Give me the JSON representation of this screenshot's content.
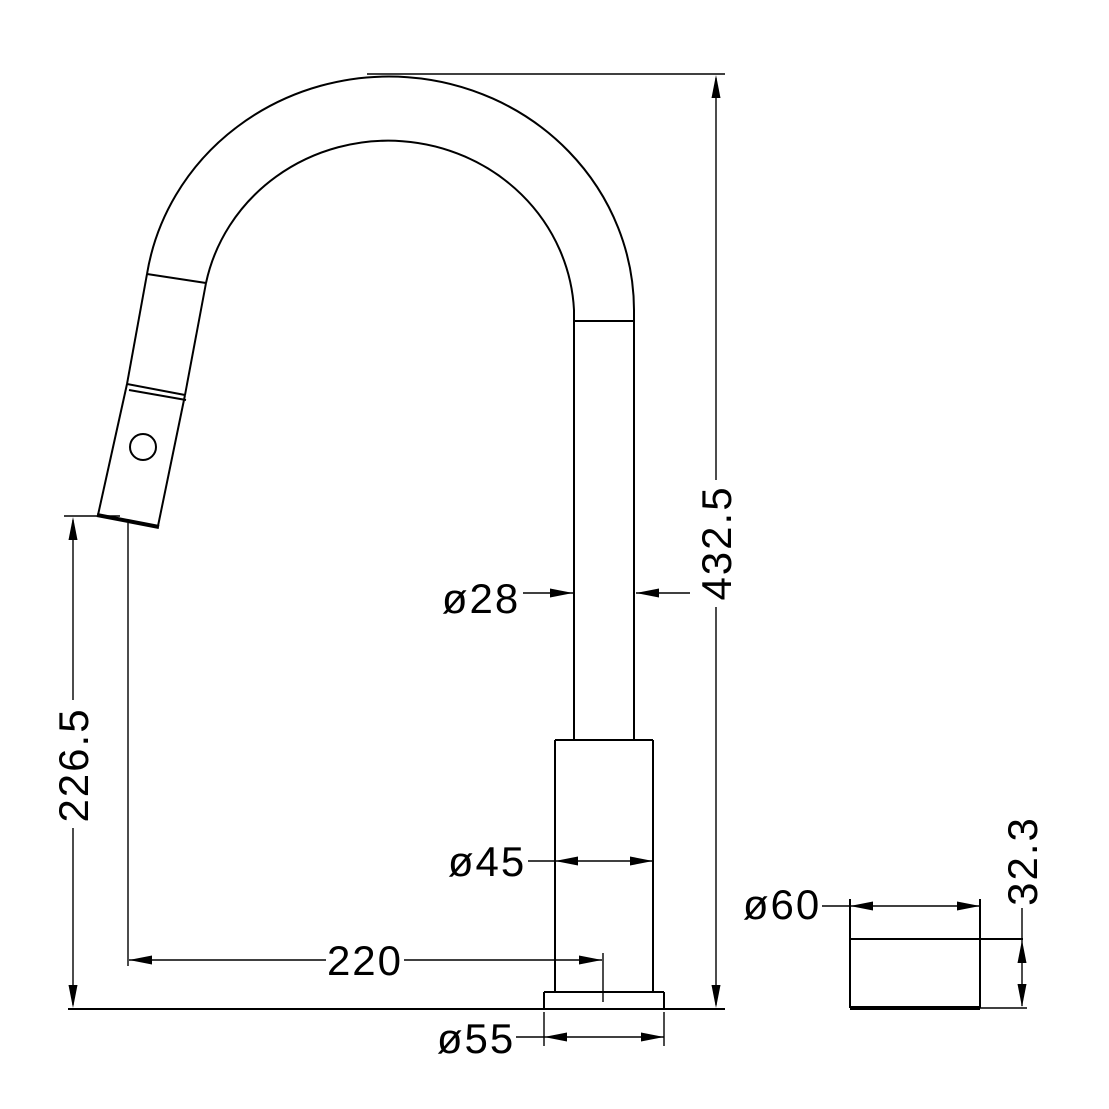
{
  "drawing": {
    "title": "pull-out-kitchen-faucet-dimension-drawing",
    "background_color": "#ffffff",
    "line_color": "#000000",
    "dimensions": {
      "overall_height": "432.5",
      "spout_outlet_height": "226.5",
      "spout_tube_diameter": "ø28",
      "body_diameter": "ø45",
      "spout_reach": "220",
      "base_diameter": "ø55",
      "cover_plate_diameter": "ø60",
      "cover_plate_height": "32.3"
    }
  }
}
